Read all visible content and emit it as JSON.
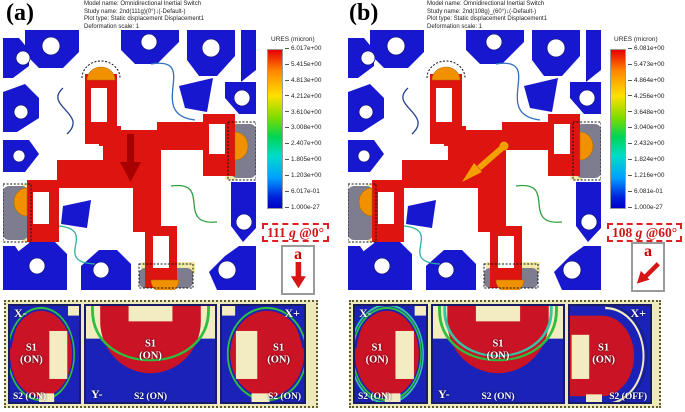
{
  "figure": {
    "colors": {
      "frame_blue": "#1717CF",
      "proof_mass_red": "#DD1410",
      "contact_orange": "#F29100",
      "pad_gray": "#7D7D8F",
      "pad_cream": "#F2EBA8",
      "annotation_red": "#D01515",
      "contour_green": "#2FBE3E",
      "contour_teal": "#35C4A5",
      "contour_navy": "#16207F",
      "strip_background": "#EFEABC"
    },
    "panels": [
      {
        "label": "(a)",
        "header": [
          "Model name: Omnidirectional Inertial Switch",
          "Study name: 2nd(111g)(0°)↓(-Default-)",
          "Plot type: Static displacement Displacement1",
          "Deformation scale: 1"
        ],
        "legend": {
          "title": "URES (micron)",
          "ticks": [
            "6.017e+00",
            "5.415e+00",
            "4.813e+00",
            "4.212e+00",
            "3.610e+00",
            "3.008e+00",
            "2.407e+00",
            "1.805e+00",
            "1.203e+00",
            "6.017e-01",
            "1.000e-27"
          ]
        },
        "accel": {
          "value": "111",
          "unit": "g",
          "angle": "@0°"
        },
        "direction_letter": "a",
        "contacts": [
          {
            "axis": "X-",
            "s1": "S1",
            "s1_state": "(ON)",
            "s2": "S2 (ON)"
          },
          {
            "axis": "Y-",
            "s1": "S1",
            "s1_state": "(ON)",
            "s2": "S2 (ON)"
          },
          {
            "axis": "X+",
            "s1": "S1",
            "s1_state": "(ON)",
            "s2": "S2 (ON)"
          }
        ]
      },
      {
        "label": "(b)",
        "header": [
          "Model name: Omnidirectional Inertial Switch",
          "Study name: 2nd(108g)_(60°)↓(-Default-)",
          "Plot type: Static displacement Displacement1",
          "Deformation scale: 1"
        ],
        "legend": {
          "title": "URES (micron)",
          "ticks": [
            "6.081e+00",
            "5.473e+00",
            "4.864e+00",
            "4.256e+00",
            "3.648e+00",
            "3.040e+00",
            "2.432e+00",
            "1.824e+00",
            "1.216e+00",
            "6.081e-01",
            "1.000e-27"
          ]
        },
        "accel": {
          "value": "108",
          "unit": "g",
          "angle": "@60°"
        },
        "direction_letter": "a",
        "contacts": [
          {
            "axis": "X-",
            "s1": "S1",
            "s1_state": "(ON)",
            "s2": "S2 (ON)"
          },
          {
            "axis": "Y-",
            "s1": "S1",
            "s1_state": "(ON)",
            "s2": "S2 (ON)"
          },
          {
            "axis": "X+",
            "s1": "S1",
            "s1_state": "(ON)",
            "s2": "S2 (OFF)"
          }
        ]
      }
    ]
  }
}
